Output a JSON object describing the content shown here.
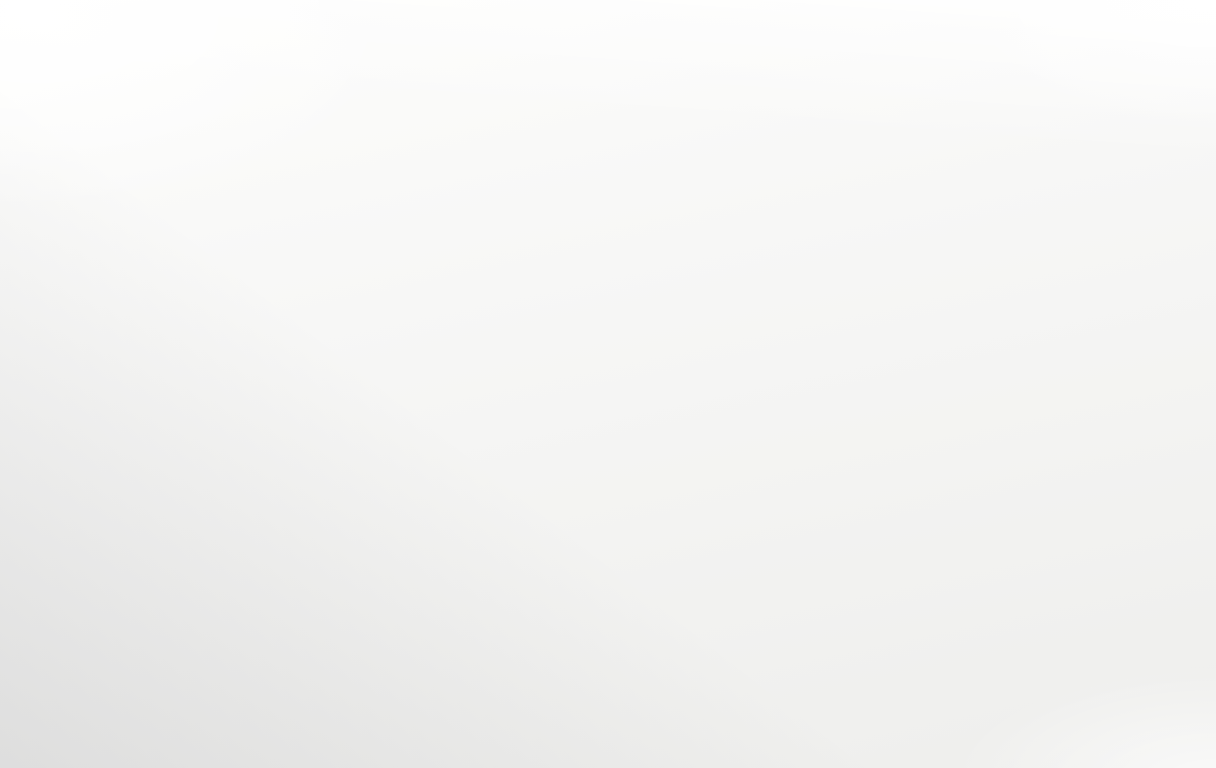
{
  "meta": {
    "scene_kind": "perspective-photo-of-paper-city-transit-map",
    "legibility": "micro-text-illegible"
  },
  "map": {
    "width": 1216,
    "height": 768,
    "seed": 11,
    "colors": {
      "paper_top": "#fbfbfa",
      "paper_bottom": "#eeeeed",
      "ink": "#161616",
      "street_fill": "#f9f9f8",
      "street_casing": "#c4c4c4",
      "street_casing_dark": "#8f8f8f",
      "building_stroke": "#898989",
      "hatch": "#5e5e5e",
      "rail": "#2f2f2f",
      "text_ink": "#1f1f1f",
      "station_ring": "#0f0f0f",
      "minor_ring": "#141414",
      "pale_ring": "#8a8a8a"
    },
    "text_vanishing_point": [
      -584,
      379
    ],
    "ew_streets": [
      {
        "x1": 0,
        "y1": 222,
        "x2": 1216,
        "y2": -106,
        "w": 3
      },
      {
        "x1": 0,
        "y1": 249,
        "x2": 1216,
        "y2": -22,
        "w": 3.5
      },
      {
        "x1": 0,
        "y1": 278,
        "x2": 1216,
        "y2": 69,
        "w": 4
      },
      {
        "x1": 0,
        "y1": 310,
        "x2": 1216,
        "y2": 168,
        "w": 4.5
      },
      {
        "x1": 0,
        "y1": 345,
        "x2": 1216,
        "y2": 274,
        "w": 5.5,
        "dark": true
      },
      {
        "x1": 0,
        "y1": 377,
        "x2": 1216,
        "y2": 373,
        "w": 7,
        "dark": true
      },
      {
        "x1": 0,
        "y1": 412,
        "x2": 1216,
        "y2": 479,
        "w": 8,
        "dark": true
      },
      {
        "x1": 0,
        "y1": 451,
        "x2": 1216,
        "y2": 601,
        "w": 9
      },
      {
        "x1": 0,
        "y1": 495,
        "x2": 1216,
        "y2": 738,
        "w": 10.5
      },
      {
        "x1": 0,
        "y1": 537,
        "x2": 1216,
        "y2": 867,
        "w": 12
      },
      {
        "x1": 0,
        "y1": 566,
        "x2": 1216,
        "y2": 955,
        "w": 13
      }
    ],
    "ns_streets": [
      {
        "x1": -281,
        "y1": 40,
        "x2": 625,
        "y2": 768,
        "w": 10,
        "dark": true
      },
      {
        "x1": 143,
        "y1": 40,
        "x2": 521,
        "y2": 768,
        "w": 6
      },
      {
        "x1": 348,
        "y1": 40,
        "x2": 595,
        "y2": 768,
        "w": 6.5
      },
      {
        "x1": 535,
        "y1": 40,
        "x2": 666,
        "y2": 768,
        "w": 7
      },
      {
        "x1": 685,
        "y1": 40,
        "x2": 721,
        "y2": 768,
        "w": 7
      },
      {
        "x1": 846,
        "y1": 40,
        "x2": 773,
        "y2": 768,
        "w": 7.5
      },
      {
        "x1": 982,
        "y1": 40,
        "x2": 847,
        "y2": 768,
        "w": 8
      },
      {
        "x1": 1103,
        "y1": 40,
        "x2": 935,
        "y2": 768,
        "w": 8
      },
      {
        "x1": 1222,
        "y1": 40,
        "x2": 1026,
        "y2": 768,
        "w": 9
      },
      {
        "x1": -436,
        "y1": 40,
        "x2": 365,
        "y2": 768,
        "w": 9
      }
    ],
    "upper_street": {
      "x1": 378,
      "y1": 118,
      "x2": 905,
      "y2": 350,
      "w": 5,
      "rings": [
        [
          467,
          158
        ],
        [
          638,
          232
        ]
      ]
    },
    "accent_edge_line": {
      "x1": 18,
      "y1": 230,
      "x2": 95,
      "y2": 420
    },
    "dashed_route": {
      "dash": [
        13,
        8.5
      ],
      "branch_nw": {
        "points": [
          [
            118,
            142
          ],
          [
            420,
            293
          ],
          [
            472,
            322
          ],
          [
            535,
            358
          ],
          [
            600,
            396
          ]
        ],
        "w": 6
      },
      "branch_ne": {
        "points": [
          [
            600,
            396
          ],
          [
            678,
            345
          ],
          [
            727,
            315
          ],
          [
            787,
            276
          ],
          [
            1010,
            162
          ]
        ],
        "w": 6.5
      },
      "branch_sw": {
        "points": [
          [
            600,
            396
          ],
          [
            543,
            428
          ],
          [
            470,
            470
          ],
          [
            360,
            540
          ],
          [
            240,
            628
          ],
          [
            140,
            700
          ]
        ],
        "w": 8.5
      },
      "stub_sw": {
        "points": [
          [
            472,
            322
          ],
          [
            420,
            360
          ],
          [
            372,
            395
          ]
        ],
        "w": 5
      },
      "stub_ne": {
        "points": [
          [
            472,
            322
          ],
          [
            510,
            300
          ],
          [
            560,
            272
          ]
        ],
        "w": 4.5
      }
    },
    "black_line": {
      "segments": [
        {
          "d": "M1185,92 Q870,360 545,768",
          "w": 3.2
        },
        {
          "d": "M963,297 Q756,503 545,768",
          "w": 6
        },
        {
          "d": "M771,500 Q659,625 545,768",
          "w": 9.5
        }
      ]
    },
    "railways": [
      {
        "x1": 760,
        "y1": 300,
        "x2": 1216,
        "y2": 455,
        "gauge": 7,
        "angle": 19,
        "boxes": [
          [
            917,
            357
          ],
          [
            1023,
            398
          ],
          [
            1127,
            438
          ]
        ]
      },
      {
        "x1": 838,
        "y1": 523,
        "x2": 1216,
        "y2": 660,
        "gauge": 7,
        "angle": 20,
        "boxes": [
          [
            915,
            551
          ],
          [
            1060,
            604
          ]
        ]
      }
    ],
    "ladders": [
      {
        "x1": 780,
        "y1": 360,
        "x2": 1075,
        "y2": 458,
        "gap": 9,
        "step": 14
      },
      {
        "x1": 1075,
        "y1": 458,
        "x2": 1216,
        "y2": 505,
        "gap": 9,
        "step": 0
      },
      {
        "x1": 845,
        "y1": 560,
        "x2": 1216,
        "y2": 700,
        "gap": 9,
        "step": 15
      },
      {
        "x1": 900,
        "y1": 702,
        "x2": 1216,
        "y2": 800,
        "gap": 10,
        "step": 17
      },
      {
        "x1": 545,
        "y1": 438,
        "x2": 705,
        "y2": 472,
        "gap": 7,
        "step": 11
      },
      {
        "x1": 0,
        "y1": 435,
        "x2": 120,
        "y2": 455,
        "gap": 7,
        "step": 12
      }
    ],
    "hatch_clusters": [
      {
        "x": 912,
        "y": 318,
        "rot": -14,
        "cols": 3,
        "rows": 2,
        "cw": 20,
        "ch": 15
      },
      {
        "x": 1002,
        "y": 346,
        "rot": -14,
        "cols": 2,
        "rows": 3,
        "cw": 19,
        "ch": 15
      },
      {
        "x": 948,
        "y": 420,
        "rot": -12,
        "cols": 3,
        "rows": 2,
        "cw": 21,
        "ch": 16
      },
      {
        "x": 1062,
        "y": 392,
        "rot": -12,
        "cols": 2,
        "rows": 2,
        "cw": 20,
        "ch": 15
      },
      {
        "x": 800,
        "y": 452,
        "rot": -10,
        "cols": 2,
        "rows": 3,
        "cw": 20,
        "ch": 16
      },
      {
        "x": 868,
        "y": 500,
        "rot": -10,
        "cols": 3,
        "rows": 2,
        "cw": 22,
        "ch": 16
      },
      {
        "x": 1134,
        "y": 330,
        "rot": -14,
        "cols": 2,
        "rows": 2,
        "cw": 18,
        "ch": 14
      },
      {
        "x": 700,
        "y": 214,
        "rot": -16,
        "cols": 3,
        "rows": 1,
        "cw": 17,
        "ch": 13
      },
      {
        "x": 1168,
        "y": 432,
        "rot": -10,
        "cols": 2,
        "rows": 2,
        "cw": 19,
        "ch": 15
      }
    ],
    "stations": {
      "black_station": {
        "x": 599,
        "y": 396,
        "r": 19,
        "label": "IIV",
        "rot": -18
      },
      "interchanges": [
        {
          "x": 472,
          "y": 322,
          "ro": 15,
          "ri": 8,
          "rot": -15,
          "squash": 1,
          "glyph": "7"
        },
        {
          "x": 225,
          "y": 447,
          "ro": 23,
          "ri": 14,
          "rot": -18,
          "squash": 0.72,
          "glyph": ""
        },
        {
          "x": 352,
          "y": 549,
          "ro": 21,
          "ri": 13,
          "rot": -18,
          "squash": 0.72,
          "glyph": ""
        },
        {
          "x": 60,
          "y": 315,
          "ro": 12,
          "ri": 6,
          "rot": -15,
          "squash": 0.8,
          "glyph": ""
        }
      ],
      "minor_stops": [
        {
          "x": 420,
          "y": 293,
          "r": 7
        },
        {
          "x": 535,
          "y": 358,
          "r": 8
        },
        {
          "x": 678,
          "y": 345,
          "r": 8
        },
        {
          "x": 727,
          "y": 315,
          "r": 7
        },
        {
          "x": 787,
          "y": 276,
          "r": 6
        },
        {
          "x": 543,
          "y": 428,
          "r": 9
        },
        {
          "x": 497,
          "y": 305,
          "r": 5
        },
        {
          "x": 617,
          "y": 371,
          "r": 5,
          "dot": true
        }
      ],
      "route_a_stops": [
        {
          "x": 150,
          "y": 388,
          "r": 8
        },
        {
          "x": 290,
          "y": 500,
          "r": 9
        },
        {
          "x": 432,
          "y": 610,
          "r": 10
        },
        {
          "x": 505,
          "y": 670,
          "r": 11
        },
        {
          "x": 588,
          "y": 737,
          "r": 12
        }
      ]
    },
    "label_snippets": [
      "7000,-d'",
      "2 (10), -d",
      "-40 (1000)",
      "60d3(16)",
      "b1 9'70b",
      "ab a0umb=19",
      "2700B /. Entr[ trm)",
      "29003",
      "2 9(0)",
      "1770?",
      "A Tammi d",
      "complet ( Camp) q",
      "( Cammil",
      "Bust Ham Hc-",
      "Routl 4",
      "Prog? [ (mt. Clvrr Jv)",
      "JHLL at",
      "Kcnlfbatmrnt",
      "1 Lammr? 4",
      "11 ram",
      "40 (IJ0 at",
      "MNDS",
      "((Midr?",
      "ITMF",
      "Noll50d3",
      "III Mvd-",
      "7b0d5",
      "Arolll",
      "1 Gcr at",
      "EI IGA",
      "m1s1",
      "IF IGR",
      "Gb0d3(16)",
      "bll Mnnc",
      "40 d0",
      "rnmb 19",
      "d03(1b)",
      "1 ramt",
      "Mf mll",
      "IIIl at"
    ],
    "counts": {
      "labels": 96,
      "buildings": 118,
      "barcodes": 30
    }
  }
}
